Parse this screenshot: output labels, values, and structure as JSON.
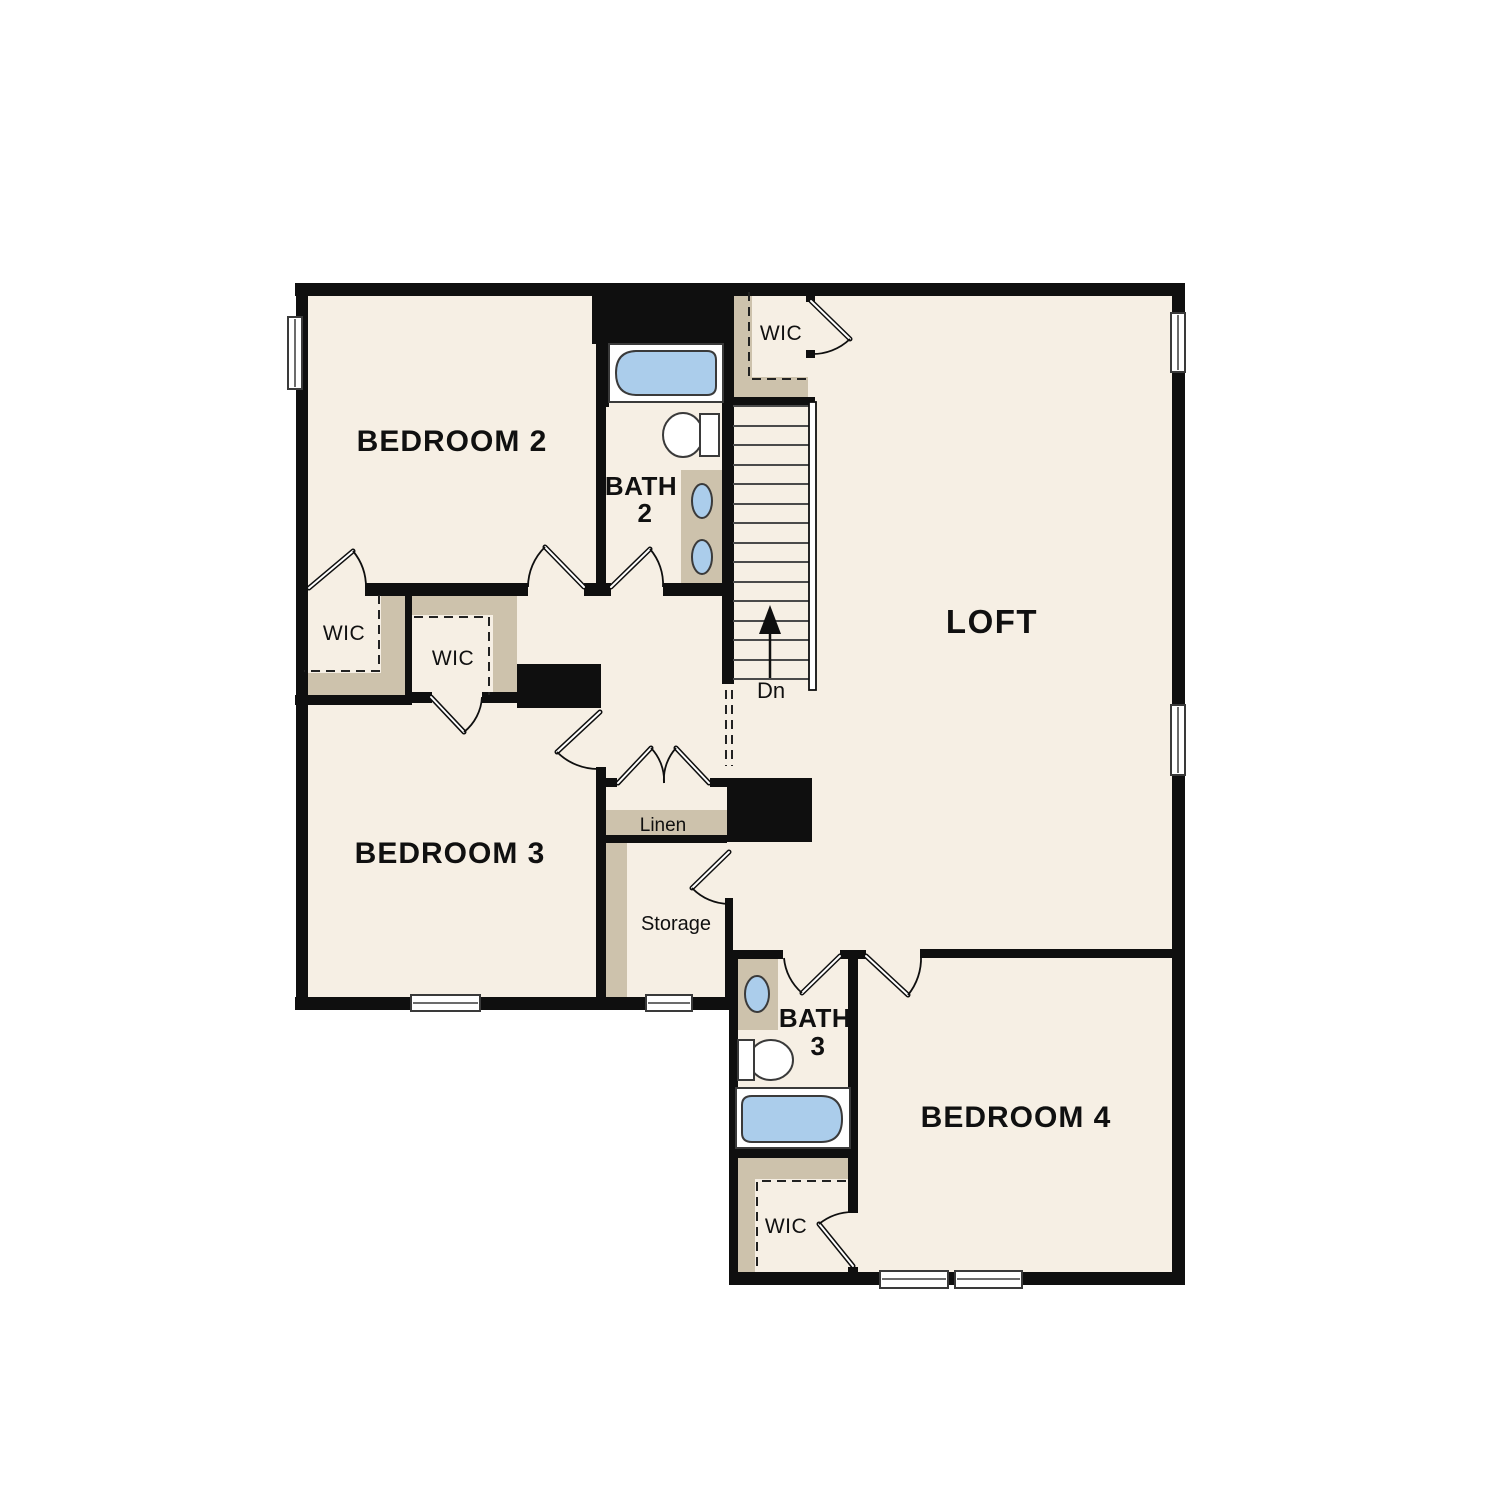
{
  "document": {
    "type": "floor-plan",
    "floor": "second-floor"
  },
  "colors": {
    "wall": "#0f0f0f",
    "floor": "#f6efe4",
    "closet_tan": "#cdc2ac",
    "fixture_blue": "#abcdeb",
    "fixture_outline": "#3a3a3a",
    "background": "#ffffff"
  },
  "rooms": {
    "bedroom2": "BEDROOM 2",
    "bath2": {
      "line1": "BATH",
      "line2": "2"
    },
    "wic_top": "WIC",
    "loft": "LOFT",
    "wic_bedroom2": "WIC",
    "wic_bedroom3": "WIC",
    "bedroom3": "BEDROOM 3",
    "linen": "Linen",
    "storage": "Storage",
    "bath3": {
      "line1": "BATH",
      "line2": "3"
    },
    "bedroom4": "BEDROOM 4",
    "wic_bedroom4": "WIC",
    "stairs": {
      "direction_label": "Dn"
    }
  }
}
